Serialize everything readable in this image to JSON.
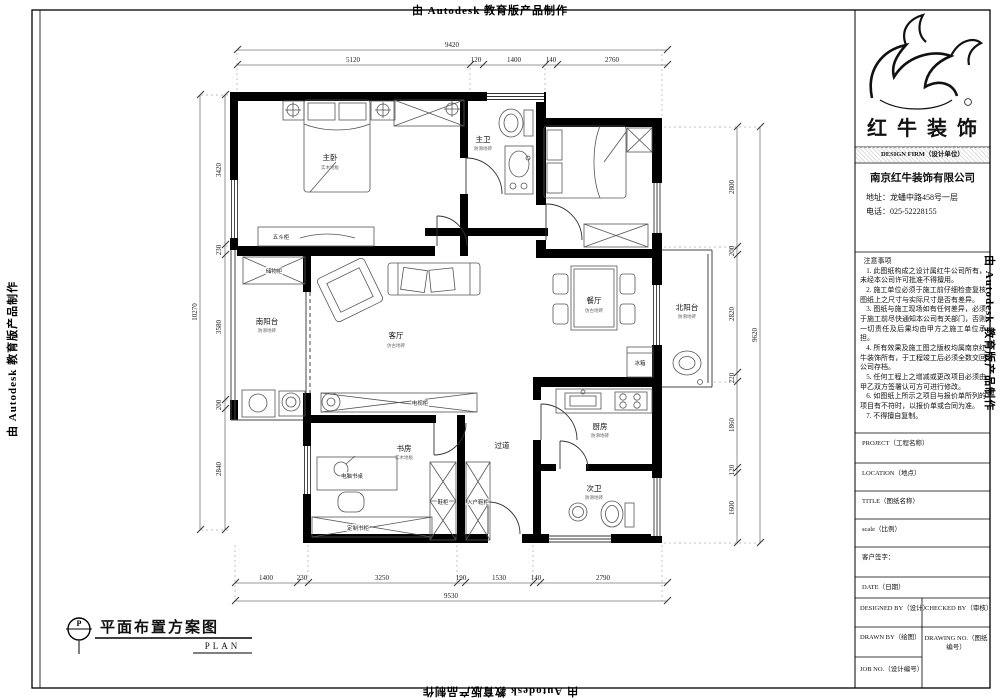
{
  "edge": {
    "autodesk": "由 Autodesk 教育版产品制作"
  },
  "plan_title": {
    "marker": "P",
    "title": "平面布置方案图",
    "en": "PLAN"
  },
  "dims": {
    "top": {
      "total": "9420",
      "segs": [
        "5120",
        "120",
        "1400",
        "140",
        "2760"
      ]
    },
    "bottom": {
      "total": "9530",
      "segs": [
        "1400",
        "230",
        "3250",
        "190",
        "1530",
        "140",
        "2790"
      ]
    },
    "left": {
      "total": "10270",
      "segs": [
        "3420",
        "230",
        "3580",
        "200",
        "2840"
      ]
    },
    "right": {
      "total": "9620",
      "segs": [
        "2800",
        "200",
        "2820",
        "220",
        "1860",
        "120",
        "1600"
      ]
    }
  },
  "rooms": {
    "master": {
      "name": "主卧",
      "sub": "实木地板"
    },
    "masterbath": {
      "name": "主卫",
      "sub": "防滑地砖"
    },
    "living": {
      "name": "客厅",
      "sub": "仿古地砖"
    },
    "dining": {
      "name": "餐厅",
      "sub": "仿古地砖"
    },
    "southbalcony": {
      "name": "南阳台",
      "sub": "防滑地砖"
    },
    "northbalcony": {
      "name": "北阳台",
      "sub": "防滑地砖"
    },
    "kitchen": {
      "name": "厨房",
      "sub": "防滑地砖"
    },
    "study": {
      "name": "书房",
      "sub": "实木地板"
    },
    "hallway": {
      "name": "过道"
    },
    "secondbath": {
      "name": "次卫",
      "sub": "防滑地砖"
    }
  },
  "furniture": {
    "chest": "五斗柜",
    "storage": "储物柜",
    "tvcabinet": "电视柜",
    "fridge": "冰箱",
    "desk": "电脑书桌",
    "bookcase": "定制书柜",
    "shoecab1": "鞋柜",
    "shoecab2": "入户鞋柜"
  },
  "title_block": {
    "brand": "红牛装饰",
    "design_firm": "DESIGN FIRM（设计单位）",
    "company": "南京红牛装饰有限公司",
    "address": "地址：龙蟠中路458号一层",
    "phone": "电话：025-52228155",
    "notes_title": "注意事项",
    "notes": [
      "1. 此图纸构成之设计属红牛公司所有，未经本公司许可批准不得擅用。",
      "2. 施工单位必须于施工前仔细检查复核图纸上之尺寸与实际尺寸是否有差异。",
      "3. 图纸与施工现场如有任何差异，必须于施工前尽快通知本公司有关部门，否则一切责任及后果均由甲方之施工单位承担。",
      "4. 所有效果及施工图之版权均属南京红牛装饰所有，于工程竣工后必须全数交回公司存档。",
      "5. 任何工程上之增减或更改项目必须由甲乙双方签署认可方可进行修改。",
      "6. 如图纸上所示之项目与报价单所列的项目有不符时，以报价单或合同为准。",
      "7. 不得擅自复制。"
    ],
    "fields": {
      "project": "PROJECT（工程名称）",
      "location": "LOCATION（地点）",
      "title": "TITLE（图纸名称）",
      "scale": "scale（比例）",
      "client": "客户签字：",
      "date": "DATE（日期）",
      "designed": "DESIGNED BY（设计）",
      "checked": "CHECKED BY（审核）",
      "drawn": "DRAWN BY（绘图）",
      "drawing_no": "DRAWING NO.（图纸编号）",
      "job_no": "JOB NO.（设计编号）"
    }
  }
}
